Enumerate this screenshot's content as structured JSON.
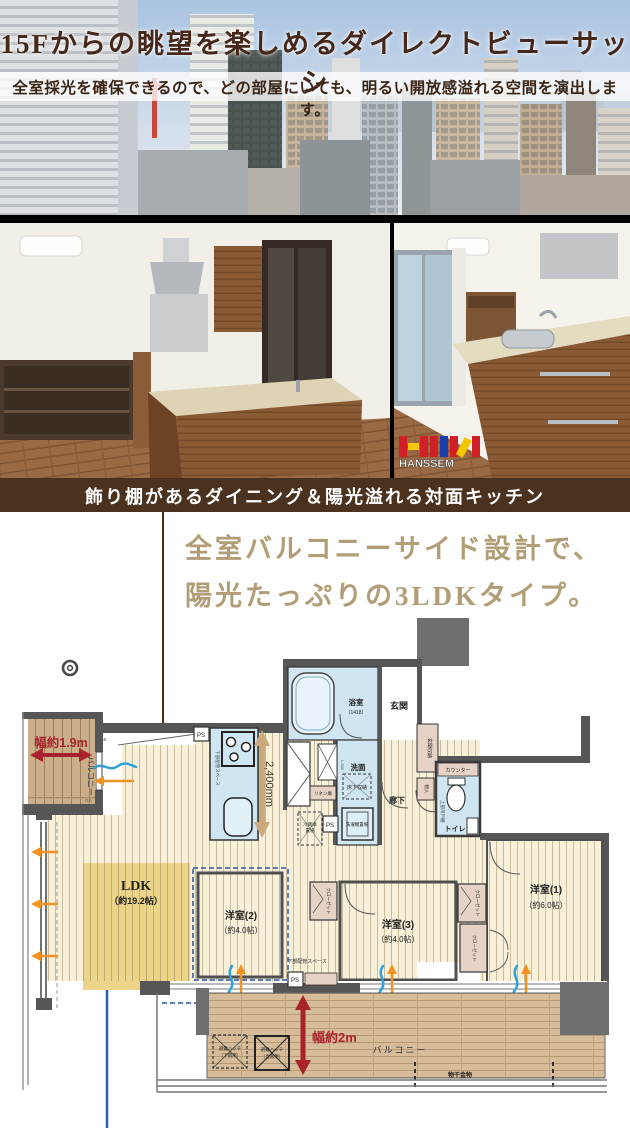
{
  "hero": {
    "title": "15Fからの眺望を楽しめるダイレクトビューサッシ",
    "subtitle": "全室採光を確保できるので、どの部屋にいても、明るい開放感溢れる空間を演出します。"
  },
  "photos": {
    "caption": "飾り棚があるダイニング＆陽光溢れる対面キッチン",
    "brand": "HANSSEM"
  },
  "lead": {
    "line1": "全室バルコニーサイド設計で、",
    "line2": "陽光たっぷりの3LDKタイプ。"
  },
  "floorplan": {
    "ldk": {
      "name": "LDK",
      "size": "（約19.2帖）"
    },
    "room1": {
      "name": "洋室(1)",
      "size": "（約6.0帖）"
    },
    "room2": {
      "name": "洋室(2)",
      "size": "（約4.0帖）"
    },
    "room3": {
      "name": "洋室(3)",
      "size": "（約4.0帖）"
    },
    "bath": {
      "name": "浴室",
      "size": "（1418）"
    },
    "senmen": "洗面",
    "genkan": "玄関",
    "rouka": "廊下",
    "toilet": "トイレ",
    "balcony": "バルコニー",
    "counter": "カウンター",
    "closet": "クローゼット",
    "monoire": "物入",
    "genkan_storage": "玄関収納",
    "linen": "リネン庫",
    "underfloor": "床下収納",
    "laundry": "洗濯機置場",
    "fridge_l1": "冷蔵庫",
    "fridge_l2": "置場",
    "upper_cabinet": "上部吊戸棚",
    "pipe_space": "下部配管スペース",
    "ps": "PS",
    "l900": "L-900",
    "dim_width19": "幅約1.9m",
    "dim_2400": "2,400mm",
    "dim_width2": "幅約2m",
    "hatch_a_l1": "避難ハッチ",
    "hatch_a_l2": "（下階用）",
    "hatch_b_l1": "避難ハッチ",
    "hatch_b_l2": "（当階用）",
    "monohoshi": "物干金物",
    "gb": "GB",
    "ga": "GA",
    "colors": {
      "wall": "#565656",
      "floor_cream": "#f8f0d8",
      "ldk_gold": "#ecd488",
      "wet_blue": "#cfe6f2",
      "closet_tan": "#e7d3c6",
      "balcony_wood": "#cfb38e",
      "dimension_red": "#a8232b",
      "pointer_brown": "#53290d",
      "pointer_blue": "#2b5cb0",
      "caption_brown": "#4a321f",
      "lead_gold": "#b29d77"
    }
  }
}
